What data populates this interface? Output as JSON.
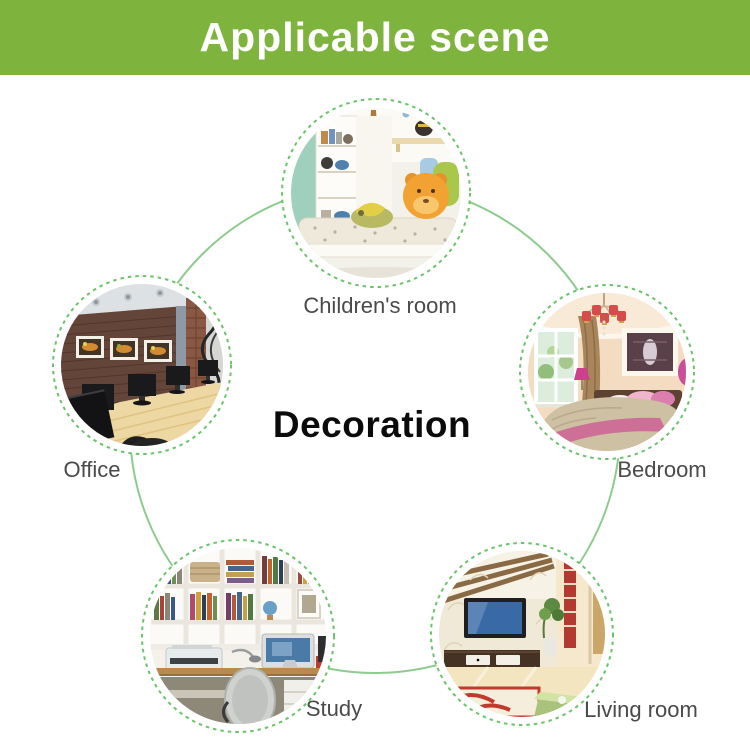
{
  "banner": {
    "title": "Applicable scene"
  },
  "center": {
    "label": "Decoration"
  },
  "nodes": [
    {
      "id": "children-room",
      "label": "Children's room"
    },
    {
      "id": "office",
      "label": "Office"
    },
    {
      "id": "bedroom",
      "label": "Bedroom"
    },
    {
      "id": "study",
      "label": "Study"
    },
    {
      "id": "living-room",
      "label": "Living room"
    }
  ],
  "colors": {
    "banner_green": "#7eb43e",
    "connector_green": "#8ecb8e",
    "ring_green": "#6cc36c",
    "label_gray": "#4a4a4a",
    "banner_text": "#ffffff",
    "center_text": "#0b0b0b"
  }
}
